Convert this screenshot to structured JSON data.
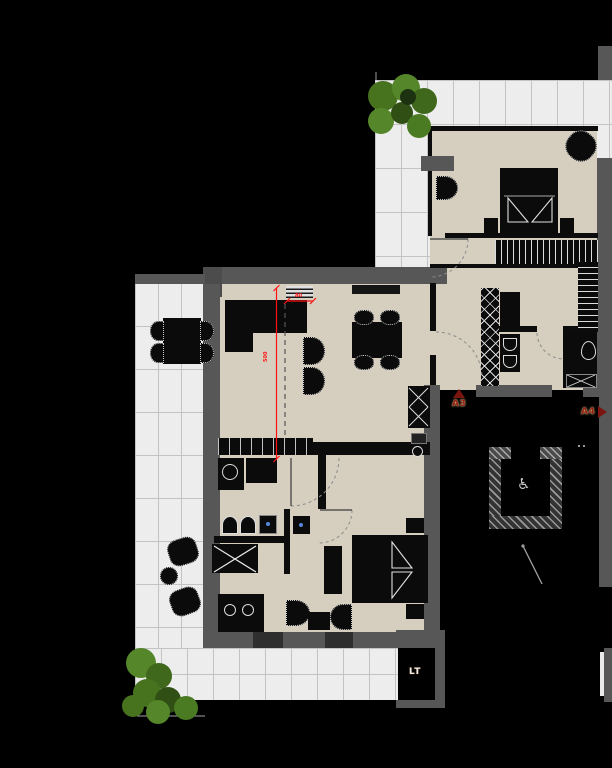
{
  "title": "apartment-floor-plan",
  "labels": {
    "section_marker_up": "A3",
    "section_marker_right": "A4",
    "shaft_label": "LT",
    "dimension_vertical": "500",
    "dimension_horizontal": "80"
  },
  "icons": {
    "wheelchair": "♿"
  },
  "colors": {
    "background": "#000000",
    "floor_interior": "#d6cfc0",
    "wall_gray": "#575757",
    "tile_paving": "#ededed",
    "furniture_dark": "#0b0b0b",
    "dimension_red": "#ff1212",
    "marker_red": "#8a2318",
    "plant_green": "#4e7d26"
  }
}
